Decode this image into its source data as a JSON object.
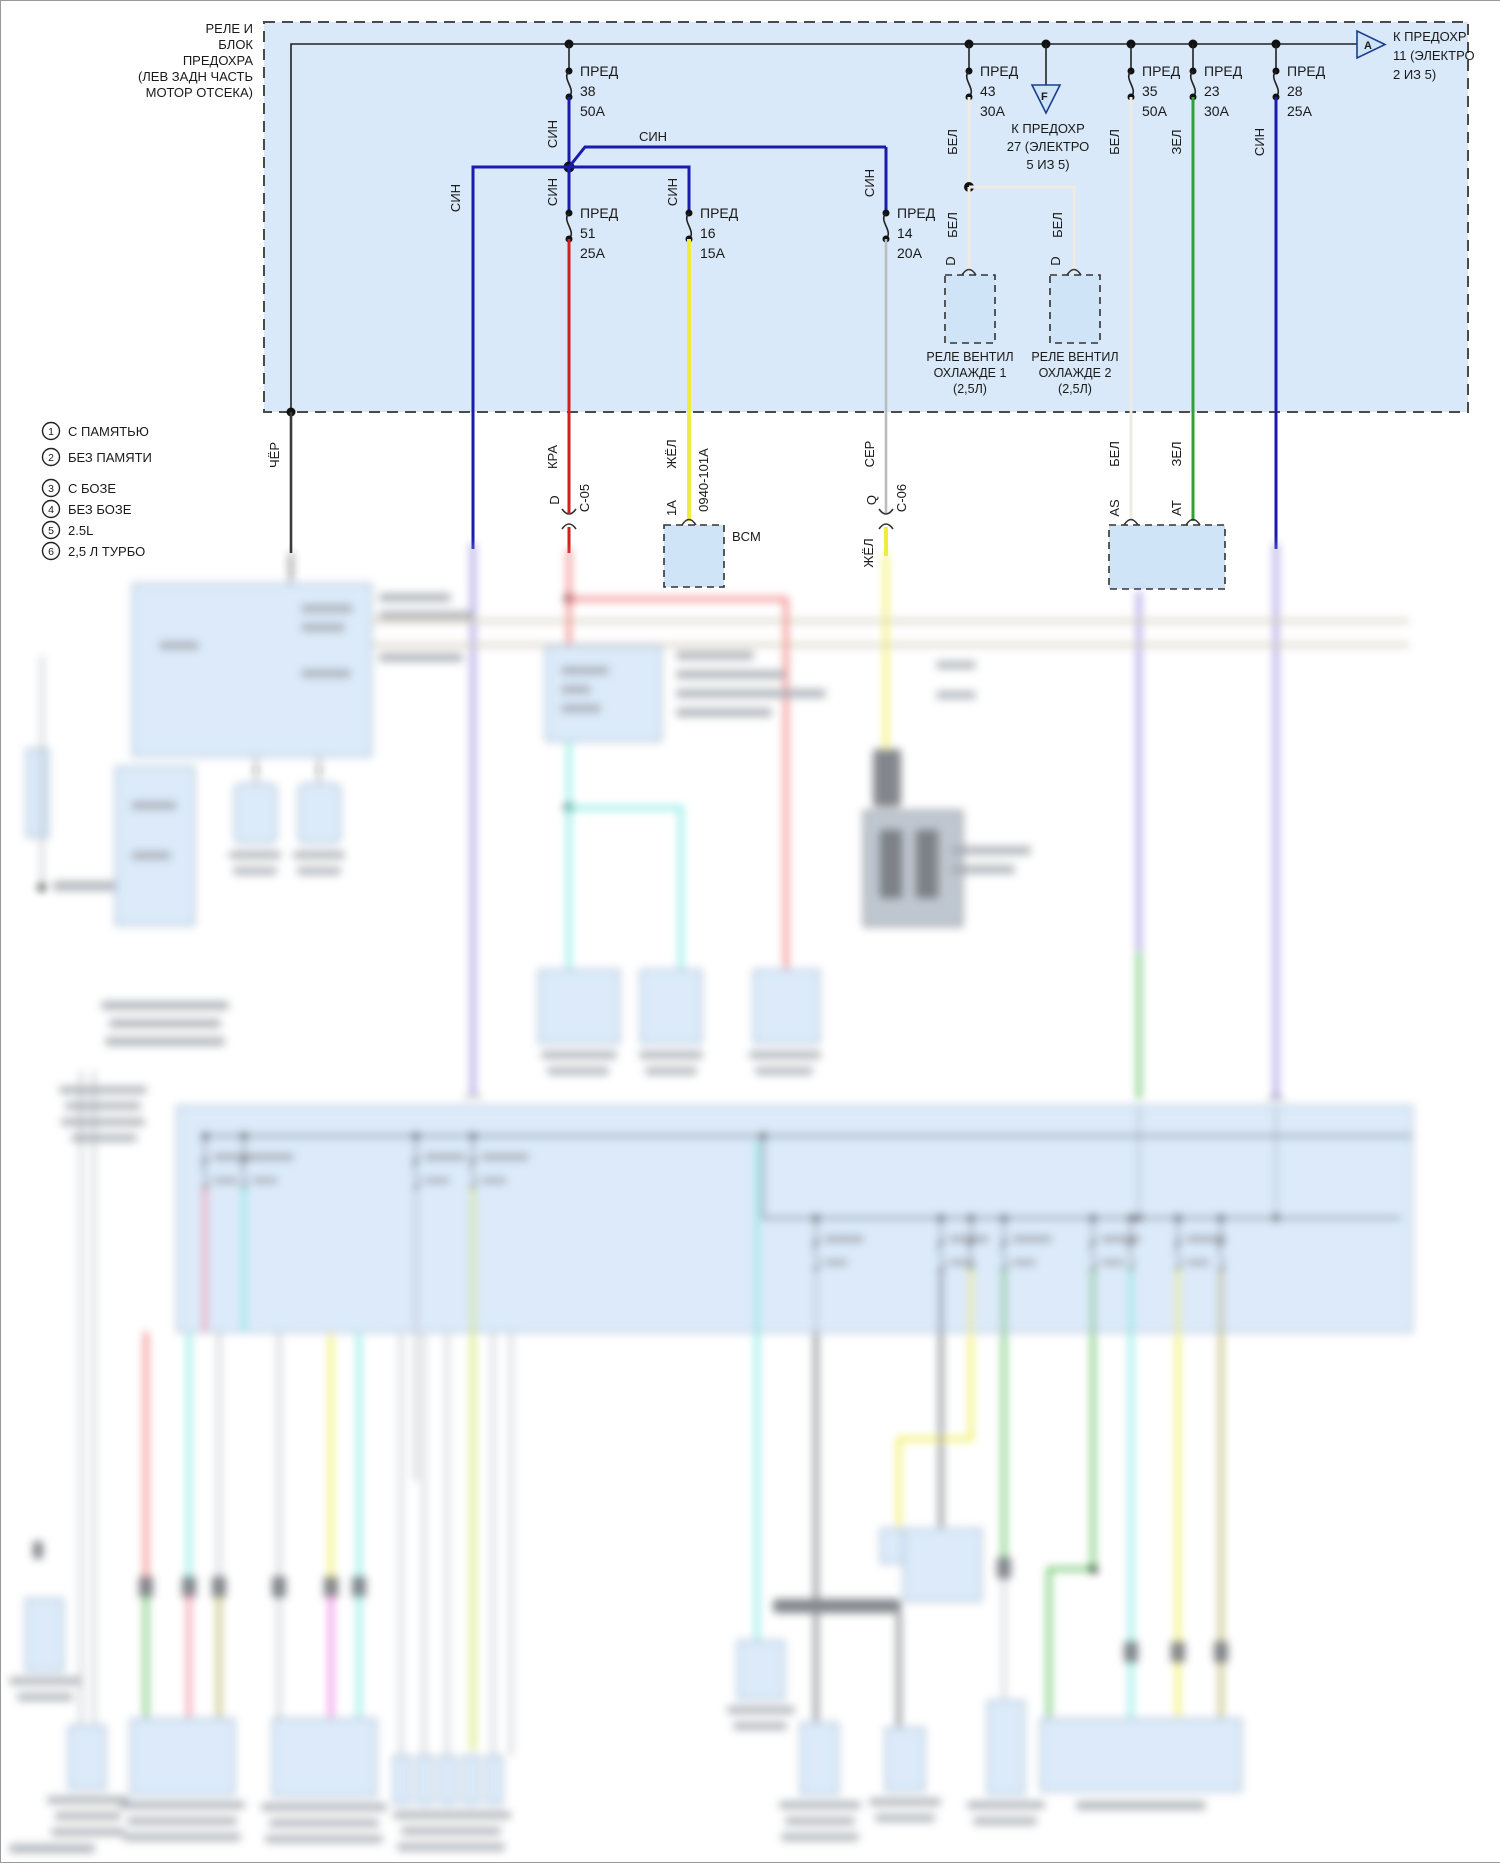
{
  "header": {
    "box_label_lines": [
      "РЕЛЕ И",
      "БЛОК",
      "ПРЕДОХРА",
      "(ЛЕВ ЗАДН ЧАСТЬ",
      "МОТОР ОТСЕКА)"
    ],
    "ref_a": {
      "letter": "А",
      "lines": [
        "К ПРЕДОХР",
        "11 (ЭЛЕКТРО",
        "2 ИЗ 5)"
      ]
    },
    "ref_f": {
      "letter": "F",
      "lines": [
        "К ПРЕДОХР",
        "27 (ЭЛЕКТРО",
        "5 ИЗ 5)"
      ]
    }
  },
  "fuses": {
    "f38": {
      "label": "ПРЕД",
      "num": "38",
      "amp": "50A"
    },
    "f51": {
      "label": "ПРЕД",
      "num": "51",
      "amp": "25A"
    },
    "f16": {
      "label": "ПРЕД",
      "num": "16",
      "amp": "15A"
    },
    "f14": {
      "label": "ПРЕД",
      "num": "14",
      "amp": "20A"
    },
    "f43": {
      "label": "ПРЕД",
      "num": "43",
      "amp": "30A"
    },
    "f35": {
      "label": "ПРЕД",
      "num": "35",
      "amp": "50A"
    },
    "f23": {
      "label": "ПРЕД",
      "num": "23",
      "amp": "30A"
    },
    "f28": {
      "label": "ПРЕД",
      "num": "28",
      "amp": "25A"
    }
  },
  "wires": {
    "sin": "СИН",
    "bel": "БЕЛ",
    "zel": "ЗЕЛ",
    "ser": "СЕР",
    "kra": "КРА",
    "zhel": "ЖЁЛ",
    "cher": "ЧЁР",
    "circuit": "0940-101A"
  },
  "connectors": {
    "c05_pin": "D",
    "c05_id": "C-05",
    "c06_pin": "Q",
    "c06_id": "C-06",
    "bcm_pin": "1A",
    "as_pin": "AS",
    "at_pin": "AT",
    "relay_pin1": "D",
    "relay_pin2": "D"
  },
  "modules": {
    "bcm": "BCM"
  },
  "relays": {
    "relay1_lines": [
      "РЕЛЕ ВЕНТИЛ",
      "ОХЛАЖДЕ 1",
      "(2,5Л)"
    ],
    "relay2_lines": [
      "РЕЛЕ ВЕНТИЛ",
      "ОХЛАЖДЕ 2",
      "(2,5Л)"
    ]
  },
  "legend": {
    "items": [
      {
        "num": "1",
        "label": "С ПАМЯТЬЮ"
      },
      {
        "num": "2",
        "label": "БЕЗ ПАМЯТИ"
      },
      {
        "num": "3",
        "label": "С БОЗЕ"
      },
      {
        "num": "4",
        "label": "БЕЗ БОЗЕ"
      },
      {
        "num": "5",
        "label": "2.5L"
      },
      {
        "num": "6",
        "label": "2,5 Л ТУРБО"
      }
    ]
  },
  "colors": {
    "box_fill": "#d9e9fa",
    "wire_blue": "#1a1aae",
    "wire_red": "#cf2020",
    "wire_yellow": "#efec3f",
    "wire_gray": "#b8bcbe",
    "wire_white": "#edebe2",
    "wire_green": "#31a037",
    "wire_black": "#3a3a3a",
    "wire_lavender": "#9d90e0"
  }
}
